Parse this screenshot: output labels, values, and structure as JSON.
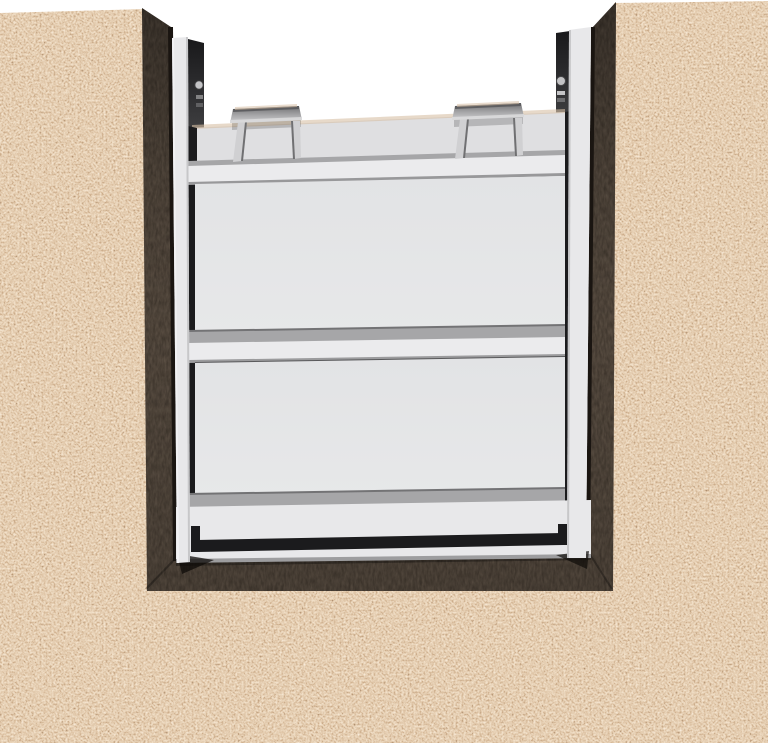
{
  "colors": {
    "background": "#ffffff",
    "concrete_base": "#e6d3bd",
    "concrete_tan": "#cfae8e",
    "concrete_brown": "#a07c5e",
    "concrete_fleck_dark": "#55504a",
    "channel_brown": "#4e453d",
    "channel_brown_deep": "#3a332c",
    "gate_white": "#e8e8ea",
    "gate_bright": "#ebebed",
    "gate_top_face": "#dfdfe1",
    "panel_light": "#e7e8e9",
    "panel_shade": "#e2e3e5",
    "strip_gray": "#a6a6a8",
    "strip_gray_dark": "#737375",
    "seam_dark": "#1b1b1d",
    "edge_gray": "#c7c7c9",
    "guide_panel_top": "#19191b",
    "guide_panel_bottom": "#3e3e40",
    "handle_dark": "#6f6f71",
    "handle_mid": "#a2a2a4",
    "handle_light": "#d0d0d2",
    "bolt_gray": "#c3c3c5",
    "warm_edge": "#d7bfa5"
  },
  "scene": {
    "parts": {
      "stop_log_panels": 2,
      "lifting_handles": 2,
      "guide_rails": 2,
      "wall_bolts": 2
    }
  }
}
